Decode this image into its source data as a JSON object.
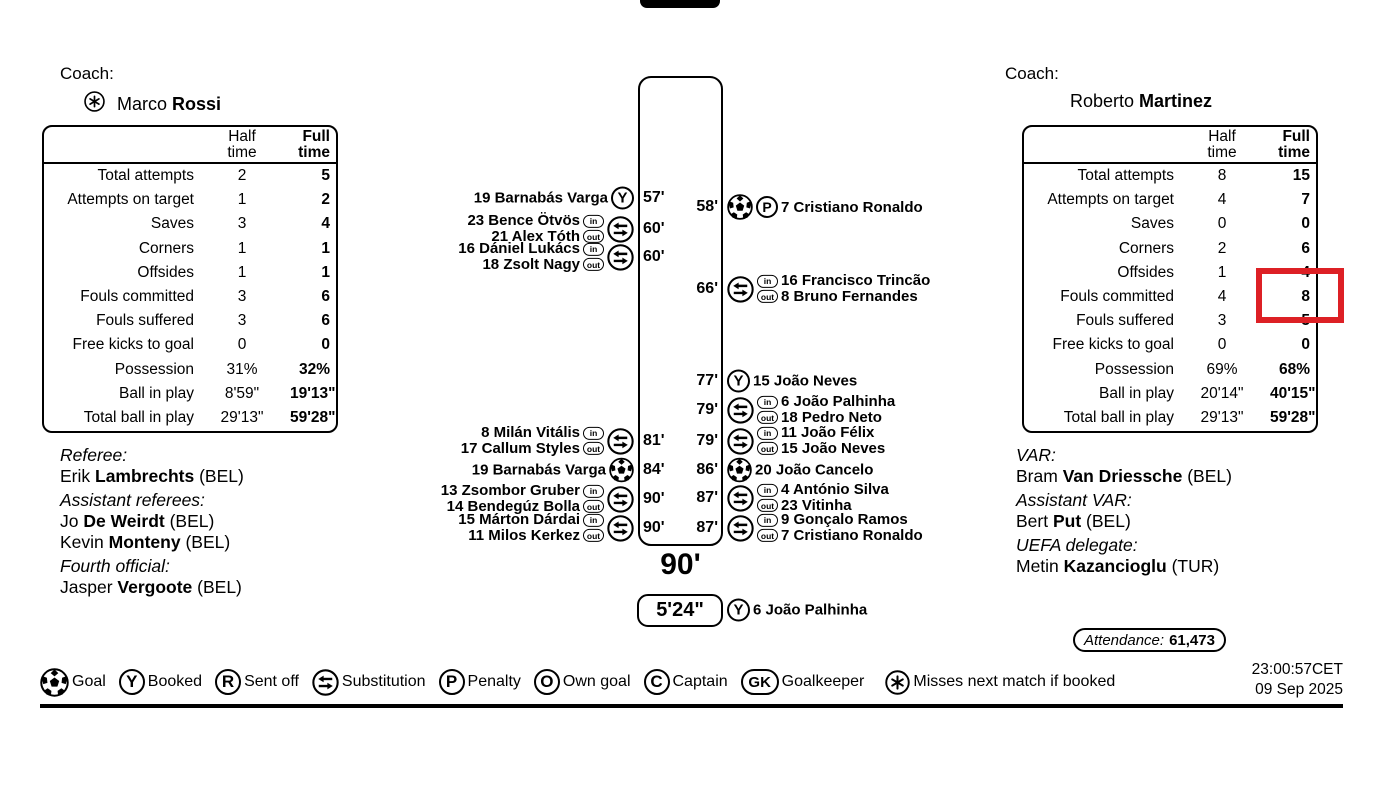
{
  "home": {
    "coach_label": "Coach:",
    "coach_first": "Marco ",
    "coach_last": "Rossi",
    "starred": true
  },
  "away": {
    "coach_label": "Coach:",
    "coach_first": "Roberto ",
    "coach_last": "Martinez",
    "starred": false
  },
  "stats": {
    "header_half": [
      "Half",
      "time"
    ],
    "header_full": [
      "Full",
      "time"
    ],
    "labels": [
      "Total attempts",
      "Attempts on target",
      "Saves",
      "Corners",
      "Offsides",
      "Fouls committed",
      "Fouls suffered",
      "Free kicks to goal",
      "Possession",
      "Ball in play",
      "Total ball in play"
    ],
    "home_half": [
      "2",
      "1",
      "3",
      "1",
      "1",
      "3",
      "3",
      "0",
      "31%",
      "8'59\"",
      "29'13\""
    ],
    "home_full": [
      "5",
      "2",
      "4",
      "1",
      "1",
      "6",
      "6",
      "0",
      "32%",
      "19'13\"",
      "59'28\""
    ],
    "away_half": [
      "8",
      "4",
      "0",
      "2",
      "1",
      "4",
      "3",
      "0",
      "69%",
      "20'14\"",
      "29'13\""
    ],
    "away_full": [
      "15",
      "7",
      "0",
      "6",
      "4",
      "8",
      "5",
      "0",
      "68%",
      "40'15\"",
      "59'28\""
    ]
  },
  "timeline": {
    "home_events": [
      {
        "minute": "57'",
        "type": "booked",
        "player": "19 Barnabás Varga"
      },
      {
        "minute": "60'",
        "type": "sub",
        "player_in": "23 Bence Ötvös",
        "player_out": "21 Alex Tóth"
      },
      {
        "minute": "60'",
        "type": "sub",
        "player_in": "16 Dániel Lukács",
        "player_out": "18 Zsolt Nagy"
      },
      {
        "minute": "81'",
        "type": "sub",
        "player_in": "8 Milán Vitális",
        "player_out": "17 Callum Styles"
      },
      {
        "minute": "84'",
        "type": "goal",
        "player": "19 Barnabás Varga"
      },
      {
        "minute": "90'",
        "type": "sub",
        "player_in": "13 Zsombor Gruber",
        "player_out": "14 Bendegúz Bolla"
      },
      {
        "minute": "90'",
        "type": "sub",
        "player_in": "15 Márton Dárdai",
        "player_out": "11 Milos Kerkez"
      }
    ],
    "away_events": [
      {
        "minute": "58'",
        "type": "penalty_goal",
        "player": "7 Cristiano Ronaldo"
      },
      {
        "minute": "66'",
        "type": "sub",
        "player_in": "16 Francisco Trincão",
        "player_out": "8 Bruno Fernandes"
      },
      {
        "minute": "77'",
        "type": "booked",
        "player": "15 João Neves"
      },
      {
        "minute": "79'",
        "type": "sub",
        "player_in": "6 João Palhinha",
        "player_out": "18 Pedro Neto"
      },
      {
        "minute": "79'",
        "type": "sub",
        "player_in": "11 João Félix",
        "player_out": "15 João Neves"
      },
      {
        "minute": "86'",
        "type": "goal",
        "player": "20 João Cancelo"
      },
      {
        "minute": "87'",
        "type": "sub",
        "player_in": "4 António Silva",
        "player_out": "23 Vitinha"
      },
      {
        "minute": "87'",
        "type": "sub",
        "player_in": "9 Gonçalo Ramos",
        "player_out": "7 Cristiano Ronaldo"
      }
    ],
    "full_time_label": "90'",
    "stoppage_time": "5'24\"",
    "stoppage_event": {
      "type": "booked",
      "player": "6 João Palhinha"
    }
  },
  "icons": {
    "booked_letter": "Y",
    "sent_off_letter": "R",
    "penalty_letter": "P",
    "own_goal_letter": "O",
    "captain_letter": "C",
    "goalkeeper_letters": "GK",
    "sub_in_text": "in",
    "sub_out_text": "out"
  },
  "officials_home": [
    {
      "style": "role",
      "text": "Referee:"
    },
    {
      "style": "name",
      "pre": "Erik ",
      "bold": "Lambrechts",
      "post": " (BEL)"
    },
    {
      "style": "role",
      "text": "Assistant referees:"
    },
    {
      "style": "name",
      "pre": "Jo ",
      "bold": "De Weirdt",
      "post": " (BEL)"
    },
    {
      "style": "name",
      "pre": "Kevin ",
      "bold": "Monteny",
      "post": " (BEL)"
    },
    {
      "style": "role",
      "text": "Fourth official:"
    },
    {
      "style": "name",
      "pre": "Jasper ",
      "bold": "Vergoote",
      "post": " (BEL)"
    }
  ],
  "officials_away": [
    {
      "style": "role",
      "text": "VAR:"
    },
    {
      "style": "name",
      "pre": "Bram ",
      "bold": "Van Driessche",
      "post": " (BEL)"
    },
    {
      "style": "role",
      "text": "Assistant VAR:"
    },
    {
      "style": "name",
      "pre": "Bert ",
      "bold": "Put",
      "post": " (BEL)"
    },
    {
      "style": "role",
      "text": "UEFA delegate:"
    },
    {
      "style": "name",
      "pre": "Metin ",
      "bold": "Kazancioglu",
      "post": " (TUR)"
    }
  ],
  "attendance_label": "Attendance:",
  "attendance_value": "61,473",
  "legend": [
    {
      "key": "goal",
      "label": "Goal"
    },
    {
      "key": "booked",
      "letter": "Y",
      "label": "Booked"
    },
    {
      "key": "sent_off",
      "letter": "R",
      "label": "Sent off"
    },
    {
      "key": "substitution",
      "label": "Substitution"
    },
    {
      "key": "penalty",
      "letter": "P",
      "label": "Penalty"
    },
    {
      "key": "own_goal",
      "letter": "O",
      "label": "Own goal"
    },
    {
      "key": "captain",
      "letter": "C",
      "label": "Captain"
    },
    {
      "key": "goalkeeper",
      "letter": "GK",
      "label": "Goalkeeper"
    },
    {
      "key": "misses_next",
      "label": "Misses next match if booked"
    }
  ],
  "timestamp_line1": "23:00:57CET",
  "timestamp_line2": "09 Sep 2025",
  "annotation": {
    "color": "#dd2025"
  }
}
